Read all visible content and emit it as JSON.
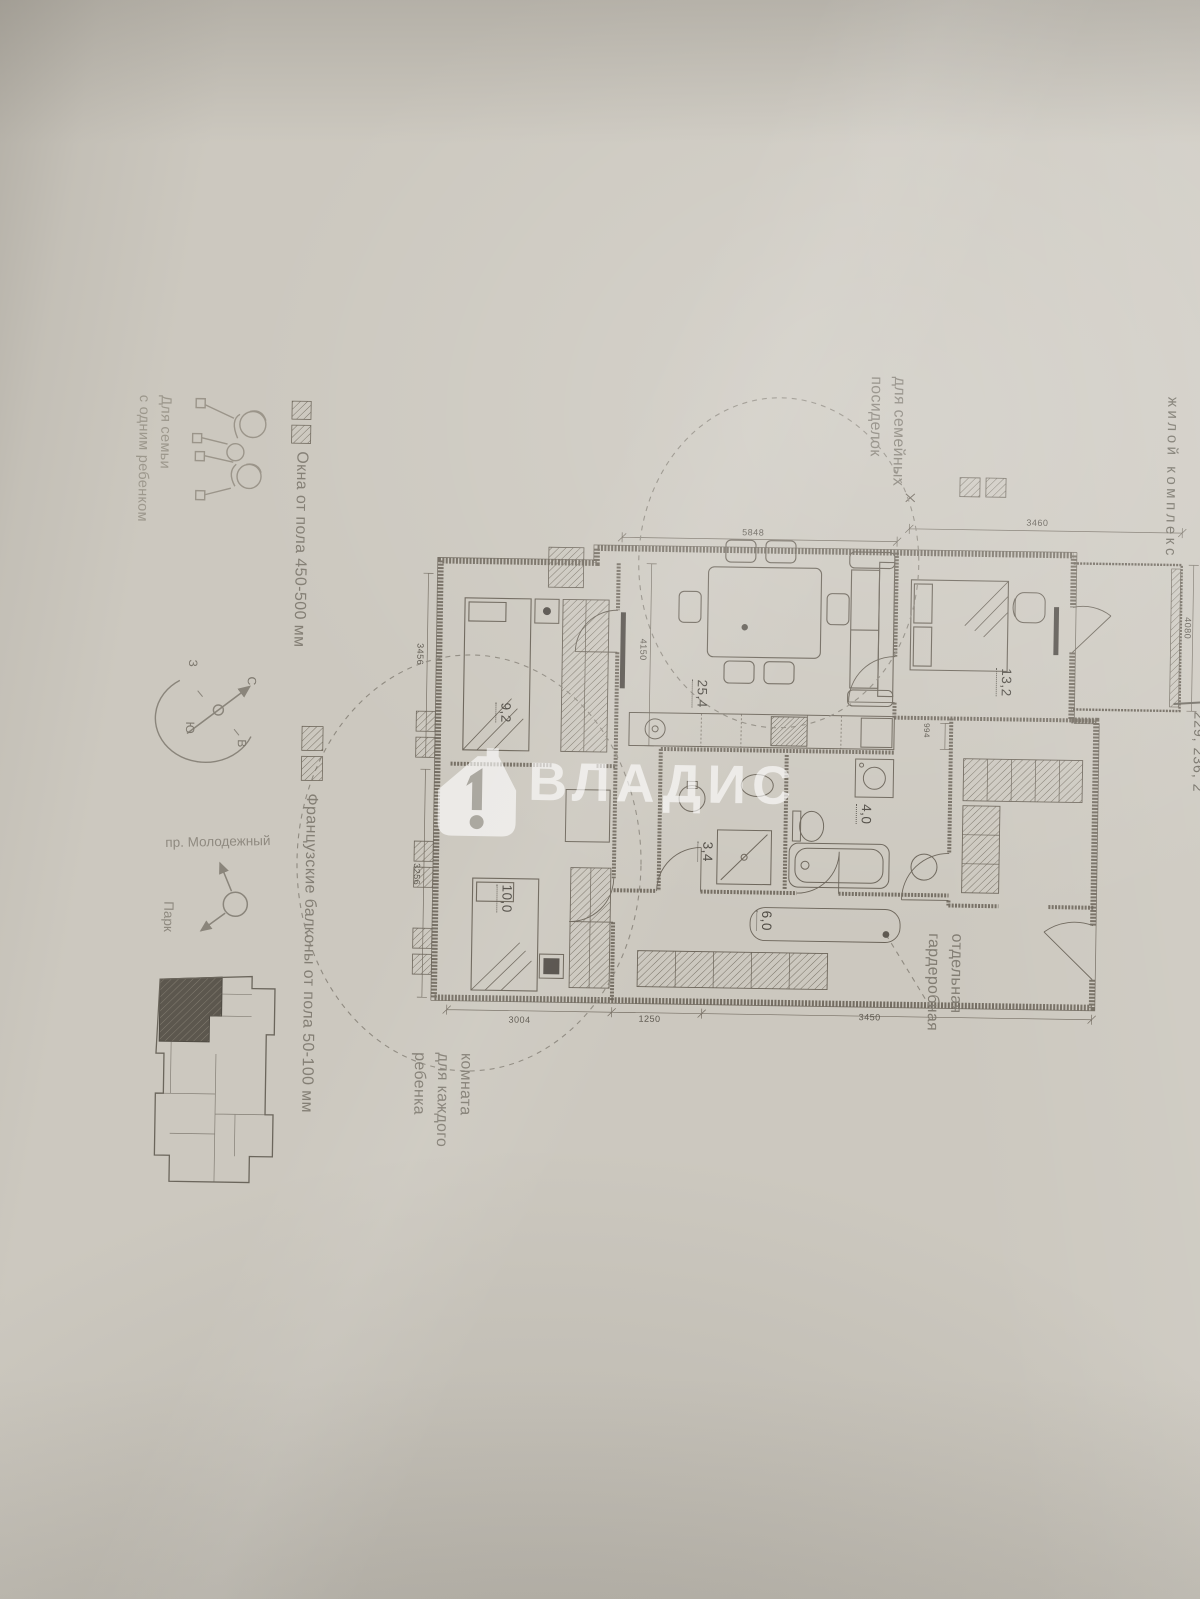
{
  "brand": {
    "fragment": "Не",
    "subtitle": "жилой комплекс",
    "apartments_fragment": "229, 236, 2"
  },
  "watermark": {
    "name": "ВЛАДИС",
    "icon": "house-with-1"
  },
  "target_audience": {
    "line1": "Для семьи",
    "line2": "с одним ребенком"
  },
  "legend": [
    {
      "icon": "window-icon",
      "label": "Окна от пола 450-500 мм"
    },
    {
      "icon": "french-balcony-icon",
      "label": "Французские балконы от пола 50-100 мм"
    }
  ],
  "site_plan": {
    "street": "пр. Молодежный",
    "park": "Парк",
    "compass": {
      "north": "С",
      "south": "Ю",
      "east": "В",
      "west": "З"
    }
  },
  "callouts": {
    "family": {
      "line1": "для семейных",
      "line2": "посиделок"
    },
    "wardrobe": {
      "line1": "отдельная",
      "line2": "гардеробная"
    },
    "children": {
      "line1": "комната",
      "line2": "для каждого",
      "line3": "ребенка"
    }
  },
  "floor_plan": {
    "rooms": [
      {
        "area": "25,4"
      },
      {
        "area": "13,2"
      },
      {
        "area": "9,2"
      },
      {
        "area": "10,0"
      },
      {
        "area": "3,4"
      },
      {
        "area": "4,0"
      },
      {
        "area": "6,0"
      }
    ],
    "dimensions": {
      "top_living": "5848",
      "top_bedroom": "3460",
      "left_upper": "3456",
      "left_lower": "3256",
      "living_inner": "4150",
      "right_balcony": "4080",
      "bottom_left": "3004",
      "bottom_middle": "1250",
      "bottom_right": "3450",
      "wardrobe_small": "994"
    }
  }
}
